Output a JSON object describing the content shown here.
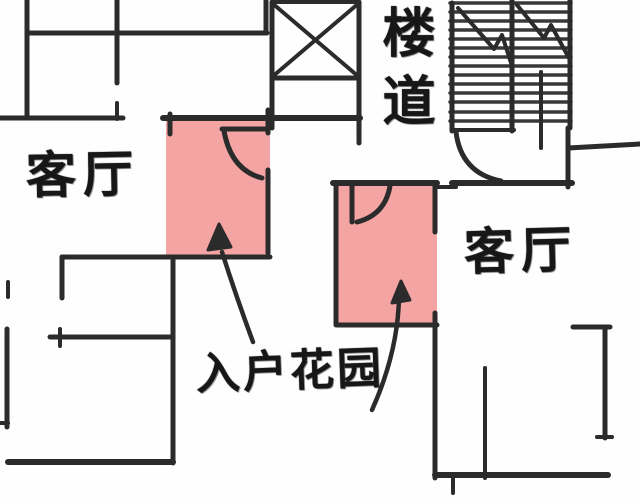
{
  "page": {
    "type": "hand-drawn floor plan sketch",
    "background": "#fffefe"
  },
  "floorplan": {
    "colors": {
      "stroke": "#2b2b2b",
      "tread_stroke": "#383838",
      "highlight": "#f5a4a4",
      "text": "#171717"
    },
    "labels": [
      {
        "id": "living-room-left",
        "text": "客厅"
      },
      {
        "id": "living-room-right",
        "text": "客厅"
      },
      {
        "id": "stairwell",
        "text": "楼道"
      },
      {
        "id": "entry-garden",
        "text": "入户花园"
      }
    ],
    "highlights": [
      {
        "name": "highlight-entry-garden-left",
        "x": 166,
        "y": 119,
        "w": 104,
        "h": 139
      },
      {
        "name": "highlight-entry-garden-right",
        "x": 336,
        "y": 184,
        "w": 101,
        "h": 141
      }
    ],
    "walls": [
      [
        27,
        0,
        27,
        118,
        5
      ],
      [
        28,
        33,
        267,
        33,
        5
      ],
      [
        117,
        0,
        117,
        83,
        5
      ],
      [
        117,
        103,
        117,
        119,
        4
      ],
      [
        0,
        118,
        123,
        118,
        5
      ],
      [
        266,
        0,
        266,
        33,
        5
      ],
      [
        272,
        2,
        272,
        128,
        5
      ],
      [
        359,
        2,
        359,
        143,
        5
      ],
      [
        272,
        2,
        359,
        2,
        4
      ],
      [
        272,
        78,
        359,
        78,
        5
      ],
      [
        272,
        3,
        359,
        77,
        4
      ],
      [
        272,
        77,
        359,
        3,
        4
      ],
      [
        163,
        118,
        360,
        118,
        6
      ],
      [
        170,
        114,
        170,
        134,
        5
      ],
      [
        268,
        110,
        268,
        133,
        5
      ],
      [
        222,
        129,
        268,
        129,
        5
      ],
      [
        268,
        170,
        268,
        253,
        5
      ],
      [
        452,
        3,
        452,
        131,
        5
      ],
      [
        512,
        0,
        512,
        131,
        5
      ],
      [
        570,
        0,
        570,
        128,
        5
      ],
      [
        452,
        130,
        514,
        130,
        4
      ],
      [
        541,
        72,
        541,
        148,
        4
      ],
      [
        568,
        128,
        568,
        187,
        5
      ],
      [
        568,
        148,
        640,
        144,
        5
      ],
      [
        452,
        183,
        572,
        183,
        6
      ],
      [
        336,
        183,
        336,
        325,
        5
      ],
      [
        333,
        183,
        437,
        183,
        6
      ],
      [
        435,
        187,
        456,
        187,
        4
      ],
      [
        435,
        184,
        435,
        232,
        5
      ],
      [
        352,
        186,
        352,
        222,
        5
      ],
      [
        337,
        325,
        437,
        325,
        5
      ],
      [
        435,
        313,
        435,
        478,
        5
      ],
      [
        435,
        475,
        608,
        475,
        6
      ],
      [
        453,
        477,
        453,
        493,
        4
      ],
      [
        485,
        368,
        485,
        478,
        4
      ],
      [
        573,
        327,
        610,
        327,
        5
      ],
      [
        605,
        327,
        605,
        438,
        5
      ],
      [
        597,
        437,
        612,
        437,
        4
      ],
      [
        62,
        257,
        270,
        257,
        5
      ],
      [
        62,
        257,
        62,
        298,
        5
      ],
      [
        8,
        282,
        8,
        297,
        4
      ],
      [
        50,
        337,
        173,
        337,
        5
      ],
      [
        60,
        329,
        60,
        346,
        4
      ],
      [
        7,
        329,
        7,
        427,
        5
      ],
      [
        0,
        423,
        8,
        423,
        4
      ],
      [
        8,
        462,
        173,
        462,
        6
      ],
      [
        173,
        257,
        173,
        463,
        5
      ]
    ],
    "stair_treads": {
      "x1": 450,
      "x2": 571,
      "width": 3.5,
      "ys": [
        3,
        12,
        21,
        30,
        39,
        48,
        57,
        66,
        75,
        84,
        93,
        102,
        112,
        121
      ]
    },
    "curves": [
      {
        "name": "door-arc-left-garden",
        "d": "M224,131 Q231,170 262,178",
        "w": 5
      },
      {
        "name": "door-arc-stairwell",
        "d": "M456,132 Q461,173 501,181",
        "w": 5
      },
      {
        "name": "door-arc-right-garden",
        "d": "M390,186 Q385,215 357,222",
        "w": 5
      },
      {
        "name": "stair-break-line-left",
        "d": "M458,8 L494,49 L502,35 L512,66",
        "w": 4
      },
      {
        "name": "stair-break-line-right",
        "d": "M517,5 L544,38 L551,25 L570,60",
        "w": 4
      },
      {
        "name": "arrow-line-left-garden",
        "d": "M253,342 Q236,296 222,252",
        "w": 4.5
      },
      {
        "name": "arrow-line-right-garden",
        "d": "M372,410 Q398,352 399,297",
        "w": 4.5
      }
    ],
    "arrowheads": [
      {
        "name": "arrowhead-left-garden",
        "points": "219,224 208,250 231,247"
      },
      {
        "name": "arrowhead-right-garden",
        "points": "401,281 392,303 410,300"
      }
    ]
  }
}
